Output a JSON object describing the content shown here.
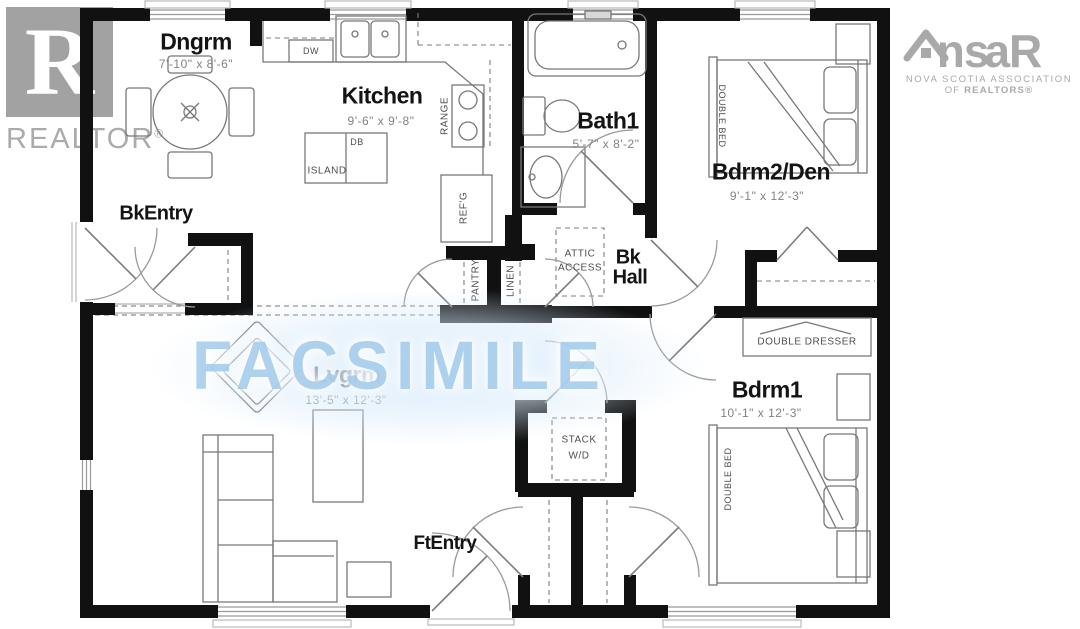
{
  "branding": {
    "realtor": {
      "monogram": "R",
      "label": "REALTOR",
      "registered": "®"
    },
    "nsar": {
      "wordmark_pre": "ns",
      "wordmark_post": "aR",
      "tagline_line1": "NOVA SCOTIA ASSOCIATION",
      "tagline_line2_prefix": "OF ",
      "tagline_line2_bold": "REALTORS®"
    }
  },
  "watermark": {
    "text": "FACSIMILE",
    "color": "#a9cfec"
  },
  "colors": {
    "walls": "#111111",
    "logo_gray": "#a8a8a8",
    "dimension_text": "#828282"
  },
  "rooms": {
    "dngrm": {
      "name": "Dngrm",
      "dims": "7'-10\" x 8'-6\""
    },
    "kitchen": {
      "name": "Kitchen",
      "dims": "9'-6\" x 9'-8\""
    },
    "bath1": {
      "name": "Bath1",
      "dims": "5'-7\" x 8'-2\""
    },
    "bdrm2": {
      "name": "Bdrm2/Den",
      "dims": "9'-1\" x 12'-3\""
    },
    "bkentry": {
      "name": "BkEntry"
    },
    "bkhall": {
      "line1": "Bk",
      "line2": "Hall"
    },
    "lvgrm": {
      "name": "Lvgrm",
      "dims": "13'-5\" x 12'-3\""
    },
    "bdrm1": {
      "name": "Bdrm1",
      "dims": "10'-1\" x 12'-3\""
    },
    "ftentry": {
      "name": "FtEntry"
    }
  },
  "fixtures": {
    "dishwasher": "DW",
    "island": "ISLAND",
    "island_db": "DB",
    "range": "RANGE",
    "fridge": "REF'G",
    "pantry": "PANTRY",
    "linen": "LINEN",
    "attic_line1": "ATTIC",
    "attic_line2": "ACCESS",
    "stack_line1": "STACK",
    "stack_line2": "W/D",
    "double_bed": "DOUBLE BED",
    "double_dresser": "DOUBLE DRESSER"
  }
}
